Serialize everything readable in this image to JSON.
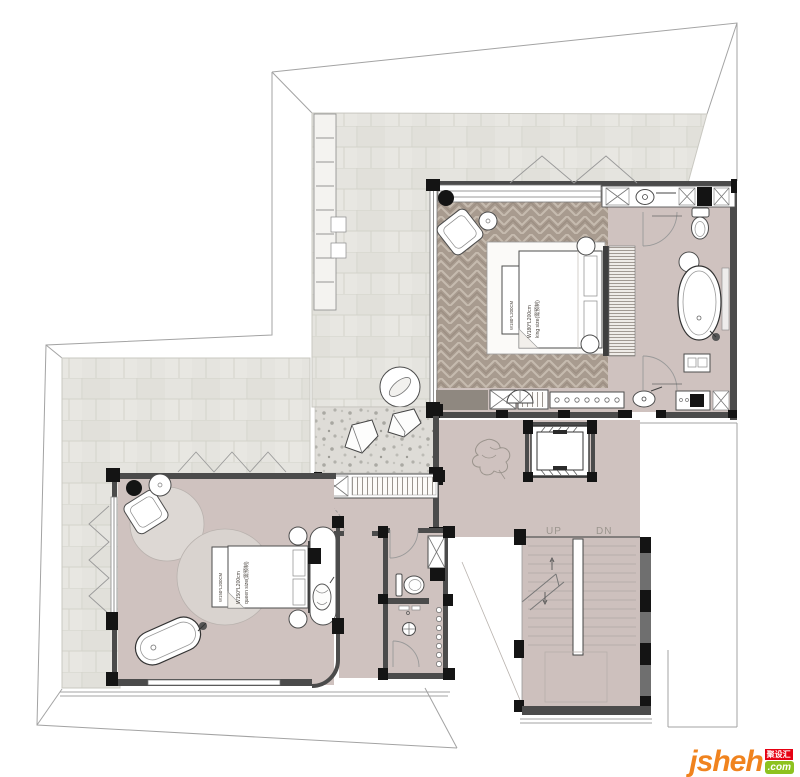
{
  "stairs": {
    "up_label": "UP",
    "down_label": "DN"
  },
  "master_bed": {
    "bench_label": "W180*L200CM",
    "size_label": "W180*L200cm",
    "type_label": "king size(需预制)"
  },
  "guest_bed": {
    "bench_label": "W150*L200CM",
    "size_label": "W150*L200cm",
    "type_label": "queen size(需预制)"
  },
  "watermark": {
    "brand": "jsheh",
    "brand_cn": "聚设汇",
    "tld": ".com"
  },
  "colors": {
    "terrace_tile": "#e5e4df",
    "wood_floor": "#a89b8f",
    "warm_floor": "#cfc2bf",
    "rug": "#d9d3cf",
    "wall": "#4b4b4b",
    "column": "#141414",
    "outline": "#a3a3a3",
    "logo_orange": "#f0831e",
    "logo_red": "#e60012",
    "logo_green": "#8dc21f"
  }
}
